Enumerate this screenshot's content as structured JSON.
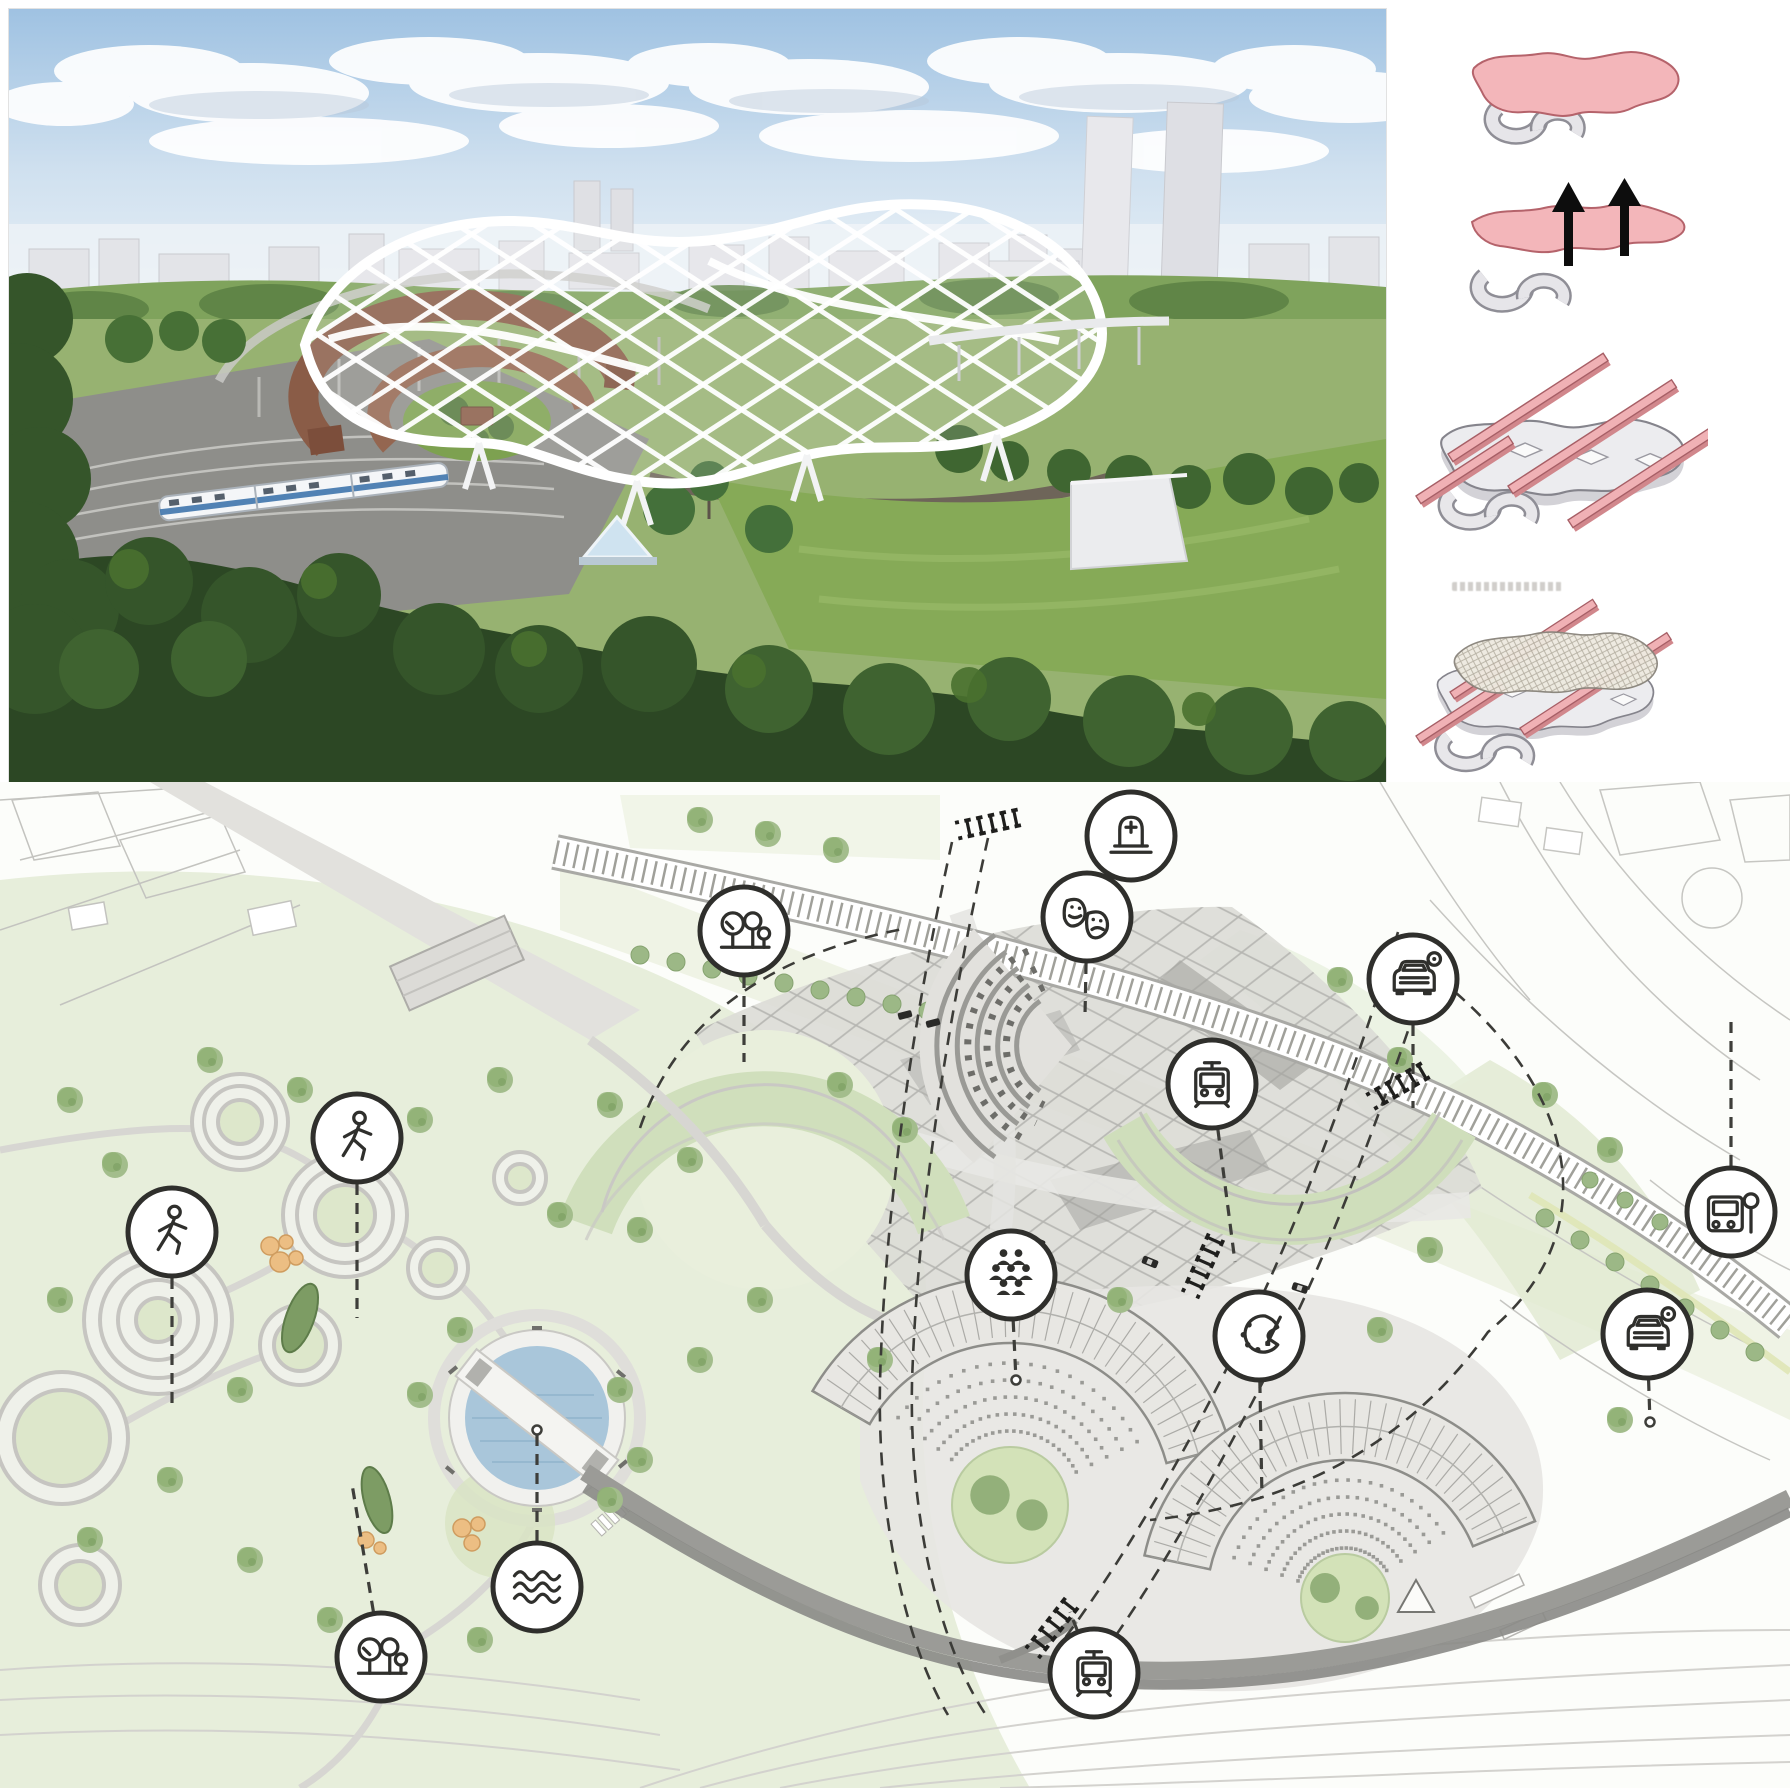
{
  "board": {
    "type": "architecture-masterplan-presentation-board"
  },
  "colors": {
    "accent_pink": "#f2b3b7",
    "pink_outline": "#b5636b",
    "diagram_grey": "#ececef",
    "line_dark": "#2f2f2c",
    "park_green": "#e7eedb",
    "tree_green": "#9cb886",
    "water_blue": "#a9c6da",
    "railway_grey": "#96968f",
    "render_sky": "#aecbe6",
    "render_lawn": "#86aa57",
    "roundhouse_brown": "#8a5c47",
    "canopy_white": "#ffffff"
  },
  "top_section": {
    "aerial_render": {
      "name": "aerial-render-lattice-roof-station"
    },
    "concept_steps": [
      {
        "step": 1,
        "name": "massing-figure",
        "elements": [
          "pink-ribbon-mass",
          "grey-roundhouse-arcs"
        ]
      },
      {
        "step": 2,
        "name": "lift-figure",
        "elements": [
          "pink-ribbon-mass",
          "up-arrows",
          "grey-roundhouse-arcs"
        ]
      },
      {
        "step": 3,
        "name": "plate-and-link-bars",
        "elements": [
          "grey-plate",
          "pink-link-bars",
          "grey-roundhouse-arcs"
        ]
      },
      {
        "step": 4,
        "name": "mesh-canopy",
        "elements": [
          "grey-plate",
          "pink-link-bars",
          "mesh-canopy"
        ],
        "caption_note": "illegible-small-caption"
      }
    ]
  },
  "site_plan": {
    "legend_icon_style": {
      "radius": 44,
      "stroke": "#2f2f2c",
      "fill": "#ffffff"
    },
    "icons": [
      {
        "name": "cemetery-icon",
        "glyph": "tombstone",
        "x": 1131,
        "y": 836,
        "leader": null
      },
      {
        "name": "theatre-masks-icon",
        "glyph": "masks",
        "x": 1087,
        "y": 917,
        "leader": {
          "x": 1085,
          "y": 1015
        }
      },
      {
        "name": "trees-icon-north",
        "glyph": "trees",
        "x": 744,
        "y": 931,
        "leader": {
          "x": 744,
          "y": 1062
        }
      },
      {
        "name": "car-parking-icon-north",
        "glyph": "car",
        "x": 1413,
        "y": 979,
        "leader": {
          "x": 1413,
          "y": 1108
        }
      },
      {
        "name": "tram-stop-icon-north",
        "glyph": "tram",
        "x": 1212,
        "y": 1084,
        "leader": {
          "x": 1235,
          "y": 1262
        }
      },
      {
        "name": "pedestrian-icon-east",
        "glyph": "pedestrian",
        "x": 357,
        "y": 1138,
        "leader": {
          "x": 357,
          "y": 1318
        }
      },
      {
        "name": "pedestrian-icon-west",
        "glyph": "pedestrian",
        "x": 172,
        "y": 1232,
        "leader": {
          "x": 172,
          "y": 1405
        }
      },
      {
        "name": "community-people-icon",
        "glyph": "people",
        "x": 1011,
        "y": 1275,
        "leader": {
          "x": 1016,
          "y": 1380
        },
        "marker": "dot"
      },
      {
        "name": "bus-stop-icon",
        "glyph": "bus",
        "x": 1731,
        "y": 1212,
        "leader": {
          "x": 1731,
          "y": 1015
        }
      },
      {
        "name": "art-palette-icon",
        "glyph": "palette",
        "x": 1259,
        "y": 1336,
        "leader": {
          "x": 1262,
          "y": 1498
        }
      },
      {
        "name": "car-parking-icon-south",
        "glyph": "car",
        "x": 1647,
        "y": 1334,
        "leader": {
          "x": 1650,
          "y": 1422
        },
        "marker": "dot"
      },
      {
        "name": "water-icon",
        "glyph": "waves",
        "x": 537,
        "y": 1587,
        "leader": {
          "x": 537,
          "y": 1430
        },
        "marker": "dot"
      },
      {
        "name": "trees-icon-south",
        "glyph": "trees",
        "x": 381,
        "y": 1657,
        "leader": {
          "x": 352,
          "y": 1484
        }
      },
      {
        "name": "tram-stop-icon-south",
        "glyph": "tram",
        "x": 1094,
        "y": 1673,
        "leader": {
          "x": 1070,
          "y": 1612
        }
      }
    ],
    "crossing_markers": [
      {
        "x": 988,
        "y": 824,
        "angle": 78
      },
      {
        "x": 1398,
        "y": 1086,
        "angle": 60
      },
      {
        "x": 1052,
        "y": 1628,
        "angle": 38
      },
      {
        "x": 1203,
        "y": 1266,
        "angle": 24
      }
    ],
    "fan_buildings": [
      {
        "cx": 1010,
        "cy": 1505,
        "r_outer": 228,
        "r_inner": 162,
        "a_start": 150,
        "a_end": 15,
        "courtyard_r": 58
      },
      {
        "cx": 1345,
        "cy": 1598,
        "r_outer": 205,
        "r_inner": 138,
        "a_start": 168,
        "a_end": 22,
        "courtyard_r": 44
      }
    ],
    "pond": {
      "cx": 537,
      "cy": 1418,
      "r_rim": 88,
      "r_water": 72
    }
  }
}
